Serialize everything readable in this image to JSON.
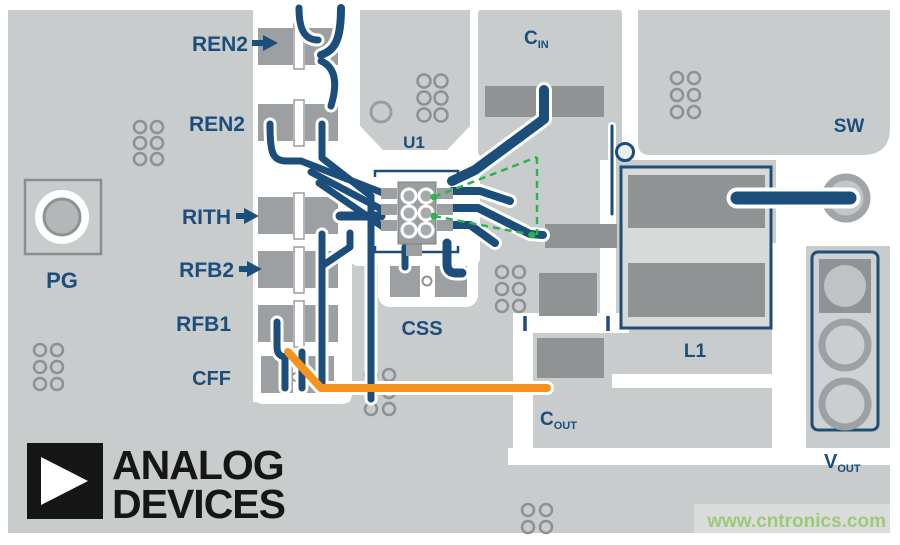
{
  "board": {
    "description": "PCB layout diagram of a DC-DC converter demo board",
    "labels": {
      "ren2_top": "REN2",
      "ren2_mid": "REN2",
      "rith": "RITH",
      "rfb2": "RFB2",
      "rfb1": "RFB1",
      "cff": "CFF",
      "pg": "PG",
      "u1": "U1",
      "css": "CSS",
      "sw": "SW",
      "l1": "L1",
      "cin": {
        "main": "C",
        "sub": "IN"
      },
      "cout": {
        "main": "C",
        "sub": "OUT"
      },
      "vout": {
        "main": "V",
        "sub": "OUT"
      }
    },
    "colors": {
      "board_gray": "#c9cccc",
      "light_gray": "#d8dada",
      "pad_gray": "#9da0a2",
      "dark_pad_gray": "#8f9394",
      "silkscreen_navy": "#1c4e7c",
      "trace_navy": "#1b4e7b",
      "highlight_orange": "#f6921e",
      "highlight_green_dashed": "#2eb34a",
      "watermark_green": "#a0c878"
    }
  },
  "logo": {
    "line1": "ANALOG",
    "line2": "DEVICES"
  },
  "watermark": {
    "text": "www.cntronics.com"
  }
}
